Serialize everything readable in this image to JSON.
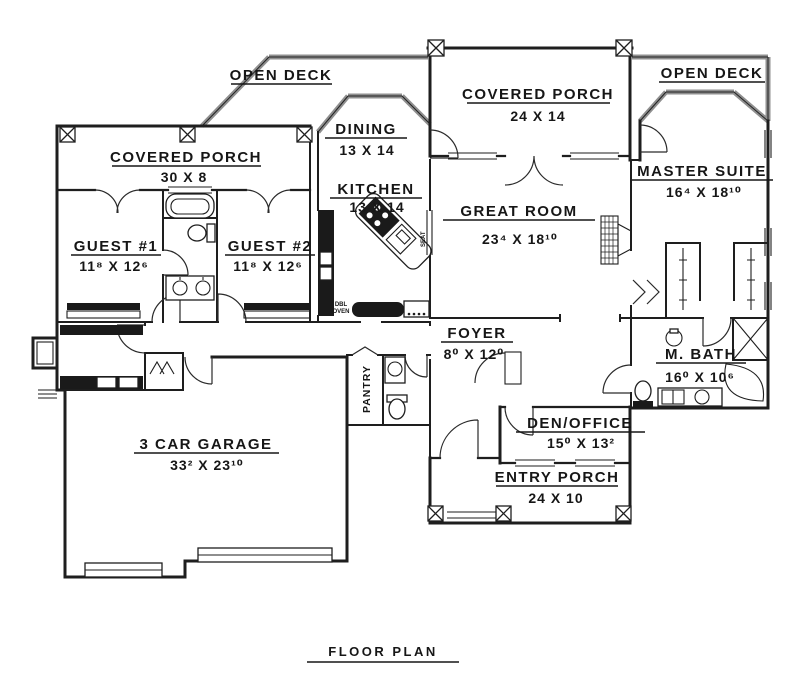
{
  "title": "FLOOR PLAN",
  "colors": {
    "line": "#1e1e1e",
    "rail_gray": "#8f8f8f",
    "background": "#ffffff"
  },
  "rooms": {
    "open_deck_left": {
      "name": "OPEN DECK"
    },
    "covered_porch_left": {
      "name": "COVERED PORCH",
      "dims": "30 X 8"
    },
    "dining": {
      "name": "DINING",
      "dims": "13 X 14"
    },
    "covered_porch_top": {
      "name": "COVERED PORCH",
      "dims": "24 X 14"
    },
    "open_deck_right": {
      "name": "OPEN DECK"
    },
    "master_suite": {
      "name": "MASTER SUITE",
      "dims": "16⁴ X 18¹⁰"
    },
    "kitchen": {
      "name": "KITCHEN",
      "dims": "13 X 14"
    },
    "great_room": {
      "name": "GREAT ROOM",
      "dims": "23⁴ X 18¹⁰"
    },
    "guest_1": {
      "name": "GUEST #1",
      "dims": "11⁸ X 12⁶"
    },
    "guest_2": {
      "name": "GUEST #2",
      "dims": "11⁸ X 12⁶"
    },
    "foyer": {
      "name": "FOYER",
      "dims": "8⁰ X 12⁰"
    },
    "master_bath": {
      "name": "M. BATH",
      "dims": "16⁰ X 10⁶"
    },
    "den_office": {
      "name": "DEN/OFFICE",
      "dims": "15⁰ X 13²"
    },
    "entry_porch": {
      "name": "ENTRY PORCH",
      "dims": "24 X 10"
    },
    "garage": {
      "name": "3 CAR GARAGE",
      "dims": "33² X 23¹⁰"
    },
    "pantry": {
      "name": "PANTRY"
    }
  },
  "annotations": {
    "dbl": "DBL",
    "oven": "OVEN",
    "seat": "SEAT"
  }
}
